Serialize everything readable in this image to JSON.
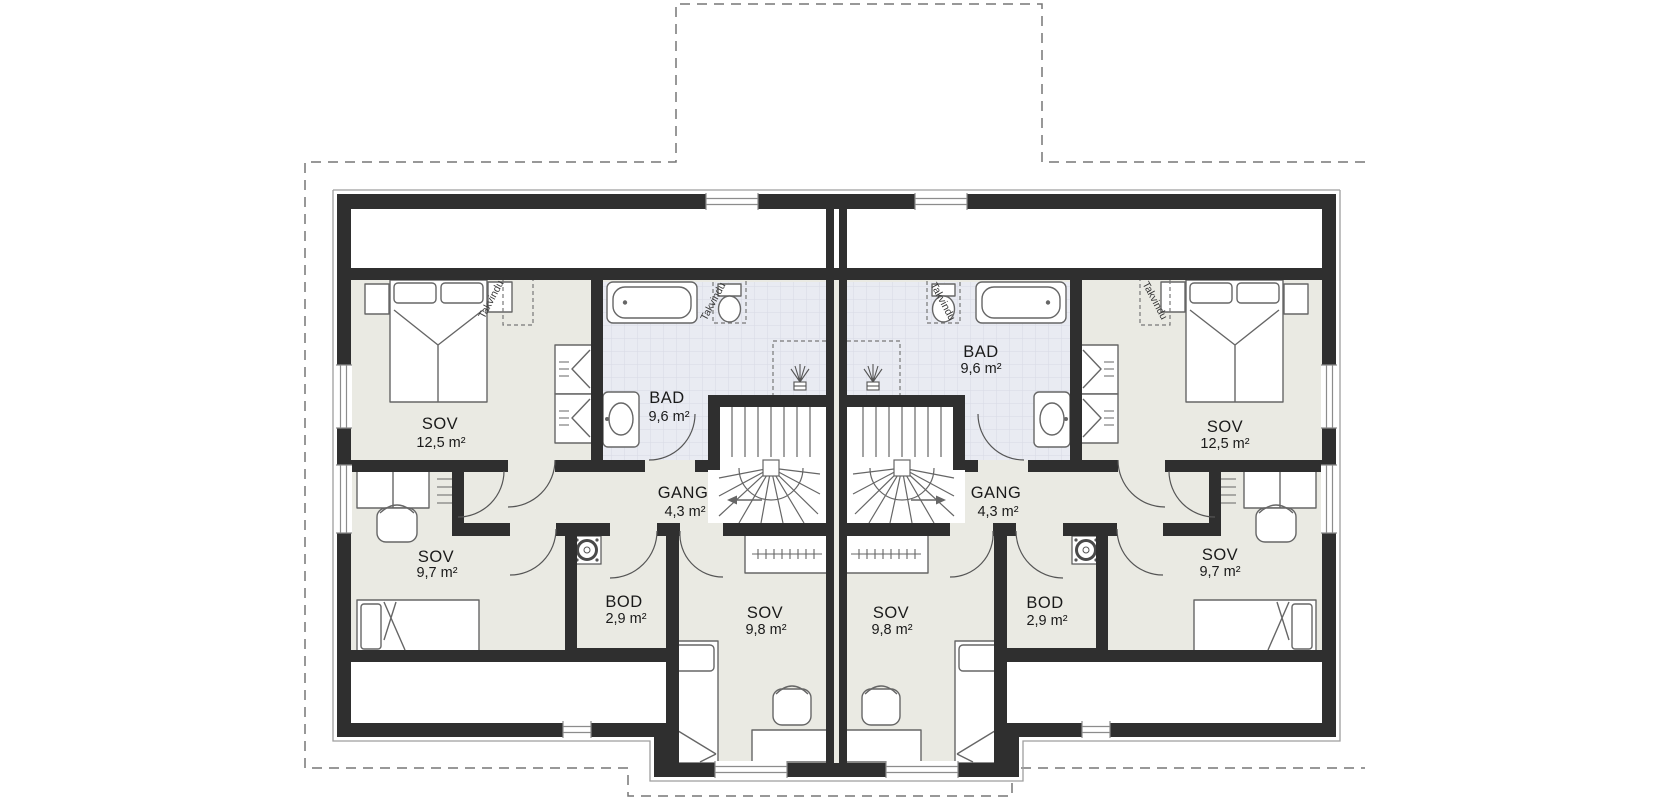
{
  "page": {
    "background": "#ffffff"
  },
  "plan": {
    "type": "floor-plan-duplex-upper-floor",
    "colors": {
      "wall": "#2f2f2f",
      "floor": "#eaeae3",
      "bathroom_floor": "#e9ebf2",
      "tile_grid": "#d7dae4",
      "thin_outline": "#9e9e9e",
      "dashed_roof_line": "#777777",
      "furniture_stroke": "#666666",
      "text": "#1a1a1a"
    },
    "units": {
      "left": {
        "rooms": [
          {
            "name": "SOV",
            "area": "12,5 m²"
          },
          {
            "name": "BAD",
            "area": "9,6 m²"
          },
          {
            "name": "GANG",
            "area": "4,3 m²"
          },
          {
            "name": "SOV",
            "area": "9,7 m²"
          },
          {
            "name": "BOD",
            "area": "2,9 m²"
          },
          {
            "name": "SOV",
            "area": "9,8 m²"
          }
        ]
      },
      "right": {
        "rooms": [
          {
            "name": "SOV",
            "area": "12,5 m²"
          },
          {
            "name": "BAD",
            "area": "9,6 m²"
          },
          {
            "name": "GANG",
            "area": "4,3 m²"
          },
          {
            "name": "SOV",
            "area": "9,7 m²"
          },
          {
            "name": "BOD",
            "area": "2,9 m²"
          },
          {
            "name": "SOV",
            "area": "9,8 m²"
          }
        ]
      }
    },
    "annotations": {
      "takvindu": "Takvindu"
    }
  }
}
